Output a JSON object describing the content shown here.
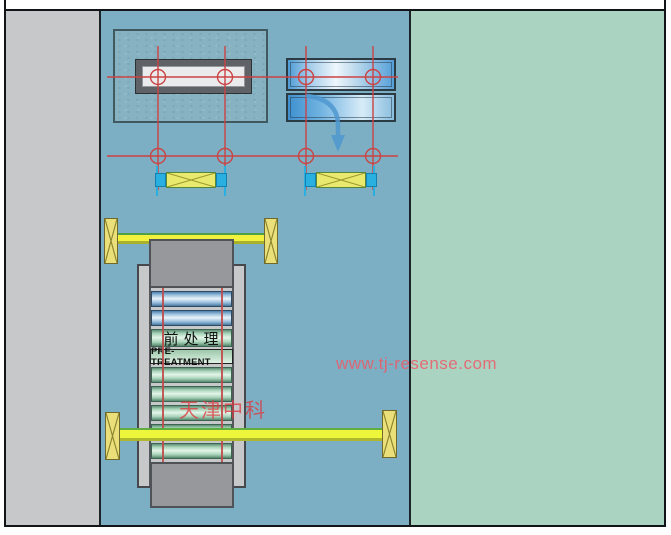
{
  "drawing": {
    "labels": {
      "process_cn": "前处理",
      "process_en": "PRE-TREATMENT"
    },
    "watermarks": {
      "site": "www.tj-resense.com",
      "company": "天津中科"
    },
    "colors": {
      "left_margin_gray": "#c6c8ca",
      "work_area_blue": "#7cafc3",
      "floor_green": "#abd3c1",
      "centerline_red": "#cb4343",
      "rail_yellow": "#f2f23e",
      "guide_cyan": "#29b0e0",
      "roller_blue": "#9cc0dd",
      "roller_green": "#a9d4ba",
      "machine_gray": "#97989c",
      "watermark_pink": "#ec5a69"
    },
    "rollers": {
      "blue_count": 2,
      "green_count": 6,
      "label_plates": 1
    }
  }
}
